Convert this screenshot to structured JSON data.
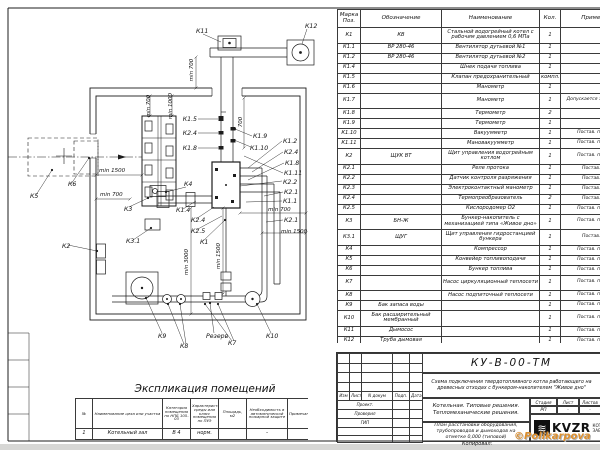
{
  "spec_table": {
    "headers": [
      "Марка Поз.",
      "Обозначение",
      "Наименование",
      "Кол.",
      "Примечание"
    ],
    "rows": [
      [
        "К1",
        "КВ",
        "Стальной водогрейный котел с рабочим давлением 0,6 МПа",
        "1",
        "",
        1
      ],
      [
        "К1.1",
        "ВР 280-46",
        "Вентилятор дутьевой №1",
        "1",
        "",
        0
      ],
      [
        "К1.2",
        "ВР 280-46",
        "Вентилятор дутьевой №2",
        "1",
        "",
        0
      ],
      [
        "К1.4",
        "",
        "Шнек подачи топлива",
        "1",
        "",
        0
      ],
      [
        "К1.5",
        "",
        "Клапан предохранительный",
        "компл.",
        "",
        0
      ],
      [
        "К1.6",
        "",
        "Манометр",
        "1",
        "",
        0
      ],
      [
        "К1.7",
        "",
        "Манометр",
        "1",
        "Допускается зам. поз. К2.3",
        1
      ],
      [
        "К1.8",
        "",
        "Термометр",
        "2",
        "",
        0
      ],
      [
        "К1.9",
        "",
        "Термометр",
        "1",
        "",
        0
      ],
      [
        "К1.10",
        "",
        "Вакуумметр",
        "1",
        "Постав. по соглас.",
        0
      ],
      [
        "К1.11",
        "",
        "Мановакуумметр",
        "1",
        "Постав. по соглас.",
        0
      ],
      [
        "К2",
        "ЩУК ВТ",
        "Щит управления водогрейным котлом",
        "1",
        "Постав. по соглас.",
        1
      ],
      [
        "К2.1",
        "",
        "Реле протока",
        "1",
        "Постав. с ЩУК",
        0
      ],
      [
        "К2.2",
        "",
        "Датчик контроля разряжения",
        "1",
        "Постав. с ЩУК",
        0
      ],
      [
        "К2.3",
        "",
        "Электроконтактный манометр",
        "1",
        "Постав. с ЩУК",
        0
      ],
      [
        "К2.4",
        "",
        "Термопреобразователь",
        "2",
        "Постав. с ЩУК",
        0
      ],
      [
        "К2.5",
        "",
        "Кислородомер О2",
        "1",
        "Постав. по соглас.",
        0
      ],
      [
        "К3",
        "БН-Ж",
        "Бункер-накопитель с механизацией типа «Живое дно»",
        "1",
        "Постав. по соглас.",
        1
      ],
      [
        "К3.1",
        "ЩУГ",
        "Щит управления гидростанцией бункера",
        "1",
        "Постав. с ЩУК",
        1
      ],
      [
        "К4",
        "",
        "Компрессор",
        "1",
        "Постав. по соглас.",
        0
      ],
      [
        "К5",
        "",
        "Конвейер топливоподачи",
        "1",
        "Постав. по соглас.",
        0
      ],
      [
        "К6",
        "",
        "Бункер топлива",
        "1",
        "Постав. по соглас.",
        0
      ],
      [
        "К7",
        "",
        "Насос циркуляционный теплосети",
        "1",
        "Постав. по соглас.",
        1
      ],
      [
        "К8",
        "",
        "Насос подпиточный теплосети",
        "1",
        "Постав. по соглас.",
        0
      ],
      [
        "К9",
        "Бак запаса воды",
        "",
        "1",
        "Постав. по соглас.",
        0
      ],
      [
        "К10",
        "Бак расширительный мембранный",
        "",
        "1",
        "Постав. по соглас.",
        1
      ],
      [
        "К11",
        "Дымосос",
        "",
        "1",
        "Постав. по соглас.",
        0
      ],
      [
        "К12",
        "Труба дымовая",
        "",
        "1",
        "Постав. по соглас.",
        0
      ]
    ]
  },
  "room_table": {
    "title": "Экспликация помещений",
    "headers": [
      "№",
      "Наименование цеха или участка",
      "Категория помещения по НПБ 105-03",
      "Характеристика среды или класс помещения по ПУЭ",
      "Площадь, м2",
      "Необходимость в автоматической пожарной защите",
      "Примечания"
    ],
    "rows": [
      [
        "1",
        "Котельный зал",
        "В 4",
        "норм.",
        "",
        "-",
        ""
      ]
    ]
  },
  "title_block": {
    "doc_code": "КУ-В-00-ТМ",
    "description": "Схема подключения твердотопливного котла работающего на древесных отходах с бункером-накопителем \"Живое дно\"",
    "org": "Котельная. Типовые решения. Тепломеханические решения.",
    "sheet_name": "План расстановки оборудования, трубопроводов и дымоходов на отметке 0,000 (типовой)",
    "stage_headers": [
      "Стадия",
      "Лист",
      "Листов"
    ],
    "stage_values": [
      "РП",
      "-",
      "-"
    ],
    "rev_headers": [
      "Изм",
      "Лист",
      "N докум",
      "Подп.",
      "Дата"
    ],
    "roles": [
      "Проект.",
      "Проверил",
      "ГИП"
    ],
    "logo_text": "KVZR",
    "logo_sub1": "КОТЕЛЬН",
    "logo_sub2": "ЗАВОД Р",
    "kopiroval": "Копировал:",
    "watermark": "©Polikarpova"
  },
  "drawing": {
    "accent_line_color": "#1c1c1c",
    "labels": [
      {
        "t": "К11",
        "x": 196,
        "y": 33
      },
      {
        "t": "К12",
        "x": 305,
        "y": 28
      },
      {
        "t": "К1.5",
        "x": 197,
        "y": 121,
        "a": "end"
      },
      {
        "t": "К2.4",
        "x": 197,
        "y": 135,
        "a": "end"
      },
      {
        "t": "К1.8",
        "x": 197,
        "y": 150,
        "a": "end"
      },
      {
        "t": "min 1500",
        "x": 99,
        "y": 172,
        "s": 5.5
      },
      {
        "t": "min 700",
        "x": 100,
        "y": 196,
        "s": 5.5
      },
      {
        "t": "К3",
        "x": 124,
        "y": 211
      },
      {
        "t": "К3.1",
        "x": 126,
        "y": 243
      },
      {
        "t": "К2",
        "x": 62,
        "y": 248
      },
      {
        "t": "К5",
        "x": 30,
        "y": 198
      },
      {
        "t": "К6",
        "x": 68,
        "y": 186
      },
      {
        "t": "К4",
        "x": 184,
        "y": 186
      },
      {
        "t": "К1.4",
        "x": 176,
        "y": 212
      },
      {
        "t": "К2.4",
        "x": 191,
        "y": 222
      },
      {
        "t": "К2.5",
        "x": 191,
        "y": 233
      },
      {
        "t": "К1",
        "x": 200,
        "y": 244
      },
      {
        "t": "К1.9",
        "x": 253,
        "y": 138
      },
      {
        "t": "К1.10",
        "x": 250,
        "y": 150
      },
      {
        "t": "К1.2",
        "x": 283,
        "y": 143
      },
      {
        "t": "К2.4",
        "x": 284,
        "y": 154
      },
      {
        "t": "К1.8",
        "x": 285,
        "y": 165
      },
      {
        "t": "К1.11",
        "x": 284,
        "y": 175
      },
      {
        "t": "К2.2",
        "x": 283,
        "y": 184
      },
      {
        "t": "К2.1",
        "x": 284,
        "y": 194
      },
      {
        "t": "К1.1",
        "x": 283,
        "y": 203
      },
      {
        "t": "min 700",
        "x": 268,
        "y": 211,
        "s": 5.5
      },
      {
        "t": "К2.1",
        "x": 284,
        "y": 222
      },
      {
        "t": "min 1500",
        "x": 281,
        "y": 233,
        "s": 5.5
      },
      {
        "t": "К9",
        "x": 158,
        "y": 338
      },
      {
        "t": "К8",
        "x": 180,
        "y": 348
      },
      {
        "t": "Резерв",
        "x": 206,
        "y": 338
      },
      {
        "t": "К7",
        "x": 228,
        "y": 345
      },
      {
        "t": "К10",
        "x": 266,
        "y": 338
      },
      {
        "t": "min 700",
        "x": 150,
        "y": 106,
        "r": -90,
        "a": "middle",
        "s": 5.5
      },
      {
        "t": "min 1000",
        "x": 172,
        "y": 106,
        "r": -90,
        "a": "middle",
        "s": 5.5
      },
      {
        "t": "700",
        "x": 242,
        "y": 122,
        "r": -90,
        "a": "middle",
        "s": 5.5
      },
      {
        "t": "min 700",
        "x": 193,
        "y": 70,
        "r": -90,
        "a": "middle",
        "s": 5.5
      },
      {
        "t": "min 3000",
        "x": 188,
        "y": 262,
        "r": -90,
        "a": "middle",
        "s": 5.5
      },
      {
        "t": "min 1500",
        "x": 220,
        "y": 256,
        "r": -90,
        "a": "middle",
        "s": 5.5
      }
    ]
  }
}
